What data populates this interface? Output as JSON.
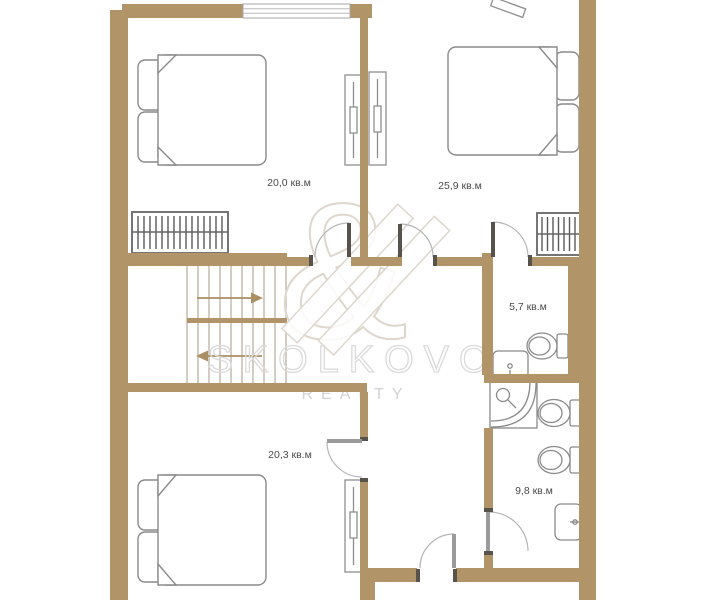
{
  "watermark": {
    "monogram": "&",
    "brand": "SKOLKOVO",
    "division": "REALTY"
  },
  "rooms": {
    "bedroom_top_left": {
      "name": "bedroom",
      "area": "20,0 кв.м"
    },
    "bedroom_top_right": {
      "name": "bedroom",
      "area": "25,9 кв.м"
    },
    "wc": {
      "name": "wc",
      "area": "5,7 кв.м"
    },
    "bedroom_bottom_left": {
      "name": "bedroom",
      "area": "20,3 кв.м"
    },
    "bathroom": {
      "name": "bathroom",
      "area": "9,8 кв.м"
    }
  },
  "stairs": {
    "up_arrow_direction": "right",
    "down_arrow_direction": "left"
  },
  "icons": [
    "double-bed-icon",
    "pillow-icon",
    "wardrobe-icon",
    "radiator-icon",
    "staircase-icon",
    "toilet-icon",
    "bidet-icon",
    "washbasin-icon",
    "corner-bath-icon",
    "door-swing-icon",
    "window-icon"
  ],
  "colors": {
    "wall": "#b29469",
    "door_jamb_dark": "#57534c",
    "door_leaf_gray": "#9b9b9b",
    "furniture_outline": "#8a8a8a",
    "stair_line": "#b6ab98",
    "stair_arrow": "#a98f63",
    "watermark": "#dcd6cc",
    "label_text": "#4b4b4b"
  }
}
